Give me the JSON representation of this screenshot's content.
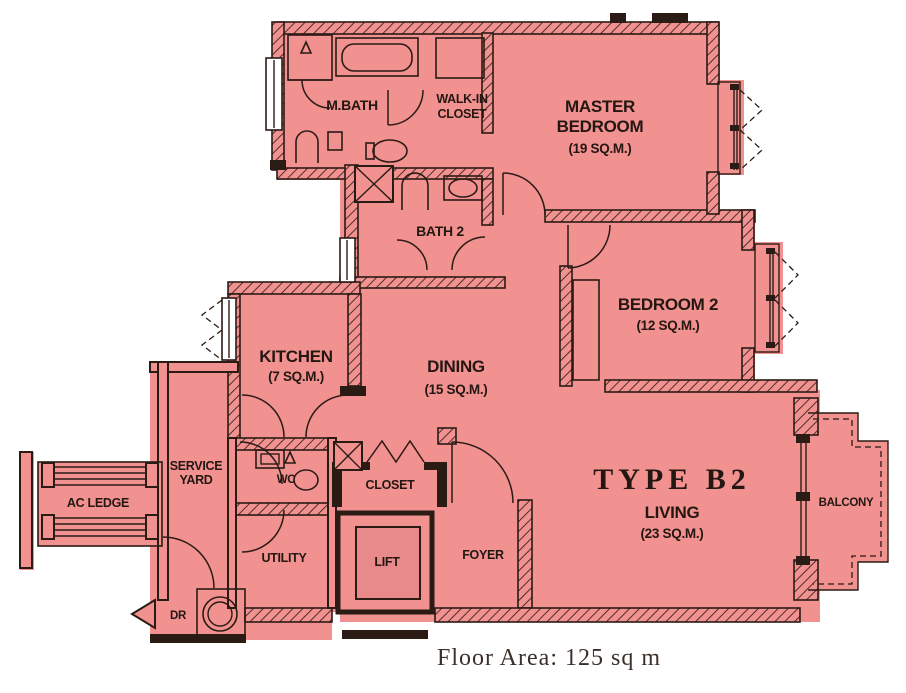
{
  "plan": {
    "type_label": "TYPE B2",
    "floor_area_caption": "Floor Area: 125 sq m",
    "colors": {
      "plan_fill": "#f19190",
      "wall": "#2b1b15",
      "lift_fill": "#e8898b",
      "label_text": "#241712",
      "background": "#ffffff"
    },
    "rooms": {
      "master_bedroom": {
        "name_line1": "MASTER",
        "name_line2": "BEDROOM",
        "area": "(19 SQ.M.)"
      },
      "bedroom_2": {
        "name": "BEDROOM 2",
        "area": "(12 SQ.M.)"
      },
      "master_bath": {
        "name": "M.BATH"
      },
      "walk_in_closet": {
        "name_line1": "WALK-IN",
        "name_line2": "CLOSET"
      },
      "bath_2": {
        "name": "BATH 2"
      },
      "kitchen": {
        "name": "KITCHEN",
        "area": "(7 SQ.M.)"
      },
      "dining": {
        "name": "DINING",
        "area": "(15 SQ.M.)"
      },
      "living": {
        "name": "LIVING",
        "area": "(23 SQ.M.)"
      },
      "service_yard": {
        "name_line1": "SERVICE",
        "name_line2": "YARD"
      },
      "ac_ledge": {
        "name": "AC LEDGE"
      },
      "wc": {
        "name": "WC"
      },
      "utility": {
        "name": "UTILITY"
      },
      "closet": {
        "name": "CLOSET"
      },
      "lift": {
        "name": "LIFT"
      },
      "foyer": {
        "name": "FOYER"
      },
      "balcony": {
        "name": "BALCONY"
      },
      "dry_riser": {
        "name": "DR"
      }
    }
  }
}
